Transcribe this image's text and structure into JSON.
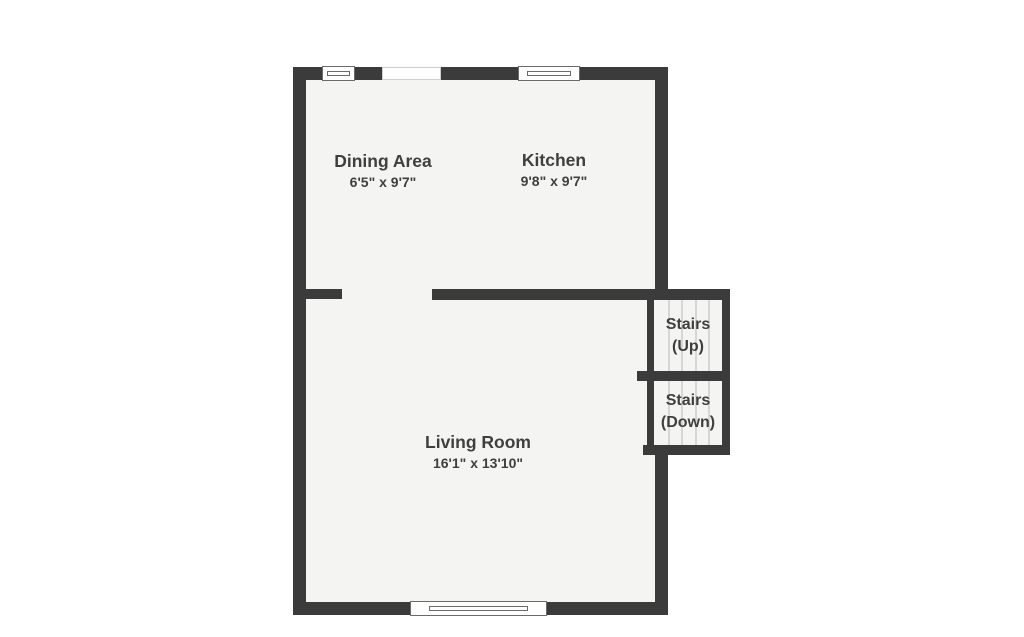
{
  "plan": {
    "title": "floor-plan",
    "rooms": [
      {
        "name": "Dining Area",
        "dimensions": "6'5\" x 9'7\""
      },
      {
        "name": "Kitchen",
        "dimensions": "9'8\" x 9'7\""
      },
      {
        "name": "Living Room",
        "dimensions": "16'1\" x 13'10\""
      }
    ],
    "stairs": [
      {
        "name": "Stairs",
        "direction": "(Up)"
      },
      {
        "name": "Stairs",
        "direction": "(Down)"
      }
    ]
  },
  "colors": {
    "wall": "#3b3b3b",
    "floor": "#f4f4f2",
    "text": "#3f3f3f",
    "tread": "#d6d6d6",
    "background": "#ffffff"
  }
}
